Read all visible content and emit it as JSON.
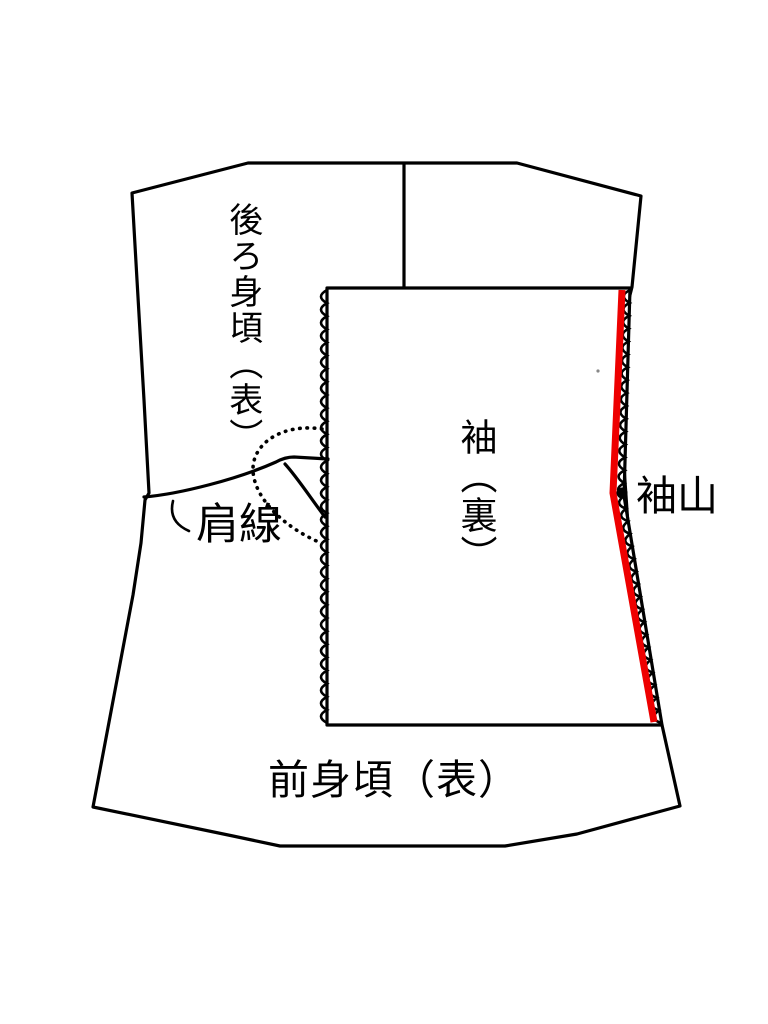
{
  "diagram": {
    "type": "sewing-pattern-instruction",
    "background_color": "#ffffff",
    "line_color": "#000000",
    "highlight_color": "#ee0000",
    "labels": {
      "back_body": "後ろ身頃（表）",
      "shoulder_line": "肩線",
      "sleeve": "袖（裏）",
      "sleeve_cap": "袖山",
      "front_body": "前身頃（表）"
    }
  }
}
